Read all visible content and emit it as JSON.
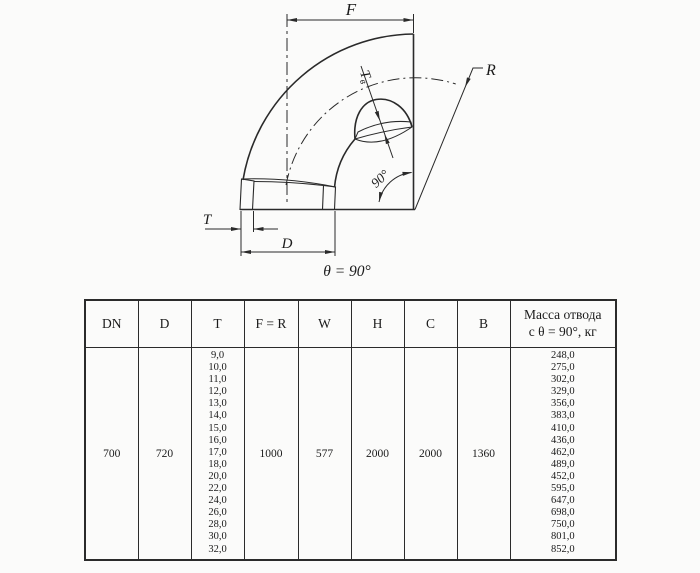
{
  "drawing": {
    "labels": {
      "f": "F",
      "r": "R",
      "t": "T",
      "d": "D",
      "tv_main": "T",
      "tv_sub": "в",
      "angle": "90°",
      "caption": "θ = 90°"
    }
  },
  "table": {
    "headers": [
      "DN",
      "D",
      "T",
      "F = R",
      "W",
      "H",
      "C",
      "B"
    ],
    "mass_header_lines": [
      "Масса отвода",
      "с θ =  90°, кг"
    ],
    "row": {
      "dn": "700",
      "d": "720",
      "t_values": [
        "9,0",
        "10,0",
        "11,0",
        "12,0",
        "13,0",
        "14,0",
        "15,0",
        "16,0",
        "17,0",
        "18,0",
        "20,0",
        "22,0",
        "24,0",
        "26,0",
        "28,0",
        "30,0",
        "32,0"
      ],
      "f_r": "1000",
      "w": "577",
      "h": "2000",
      "c": "2000",
      "b": "1360",
      "mass_values": [
        "248,0",
        "275,0",
        "302,0",
        "329,0",
        "356,0",
        "383,0",
        "410,0",
        "436,0",
        "462,0",
        "489,0",
        "452,0",
        "595,0",
        "647,0",
        "698,0",
        "750,0",
        "801,0",
        "852,0"
      ]
    }
  },
  "colors": {
    "line": "#2a2a2a",
    "background": "#fbfbfa"
  }
}
